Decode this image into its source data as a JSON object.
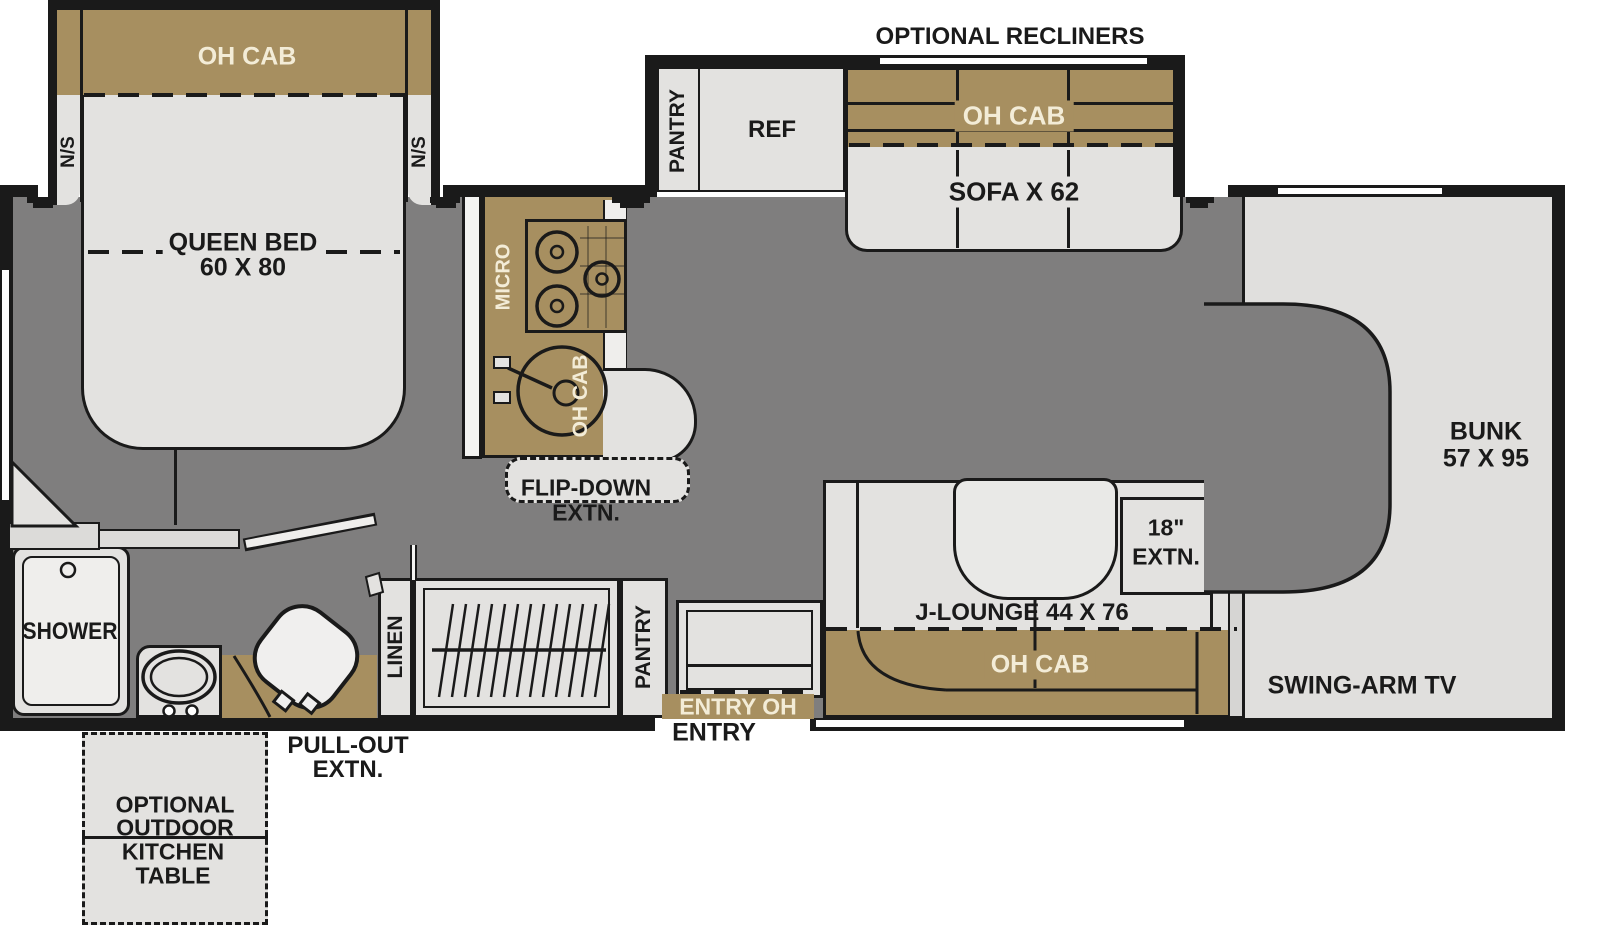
{
  "colors": {
    "wall": "#1a1a1a",
    "floor": "#7f7e7e",
    "furniture": "#e3e2e0",
    "cabinet_tan": "#a78f60",
    "cream_text": "#f3ecd7"
  },
  "floorplan": {
    "bedroom": {
      "oh_cab": "OH CAB",
      "ns_left": "N/S",
      "ns_right": "N/S",
      "bed_name": "QUEEN BED",
      "bed_size": "60 X 80"
    },
    "sofa_slide": {
      "option_title": "OPTIONAL RECLINERS",
      "pantry": "PANTRY",
      "fridge": "REF",
      "oh_cab": "OH CAB",
      "sofa": "SOFA X 62"
    },
    "kitchen": {
      "micro": "MICRO",
      "oh_cab": "OH CAB",
      "flip_down_1": "FLIP-DOWN",
      "flip_down_2": "EXTN."
    },
    "bathroom": {
      "shower": "SHOWER"
    },
    "hallway": {
      "linen": "LINEN",
      "pantry": "PANTRY",
      "entry_oh": "ENTRY OH",
      "entry": "ENTRY"
    },
    "lounge": {
      "label": "J-LOUNGE 44 X 76",
      "oh_cab": "OH CAB",
      "ext_1": "18\"",
      "ext_2": "EXTN."
    },
    "cab": {
      "bunk_1": "BUNK",
      "bunk_2": "57 X 95",
      "tv": "SWING-ARM TV"
    },
    "exterior": {
      "pull_out_1": "PULL-OUT",
      "pull_out_2": "EXTN.",
      "outdoor_1": "OPTIONAL",
      "outdoor_2": "OUTDOOR",
      "outdoor_3": "KITCHEN",
      "outdoor_4": "TABLE"
    }
  }
}
